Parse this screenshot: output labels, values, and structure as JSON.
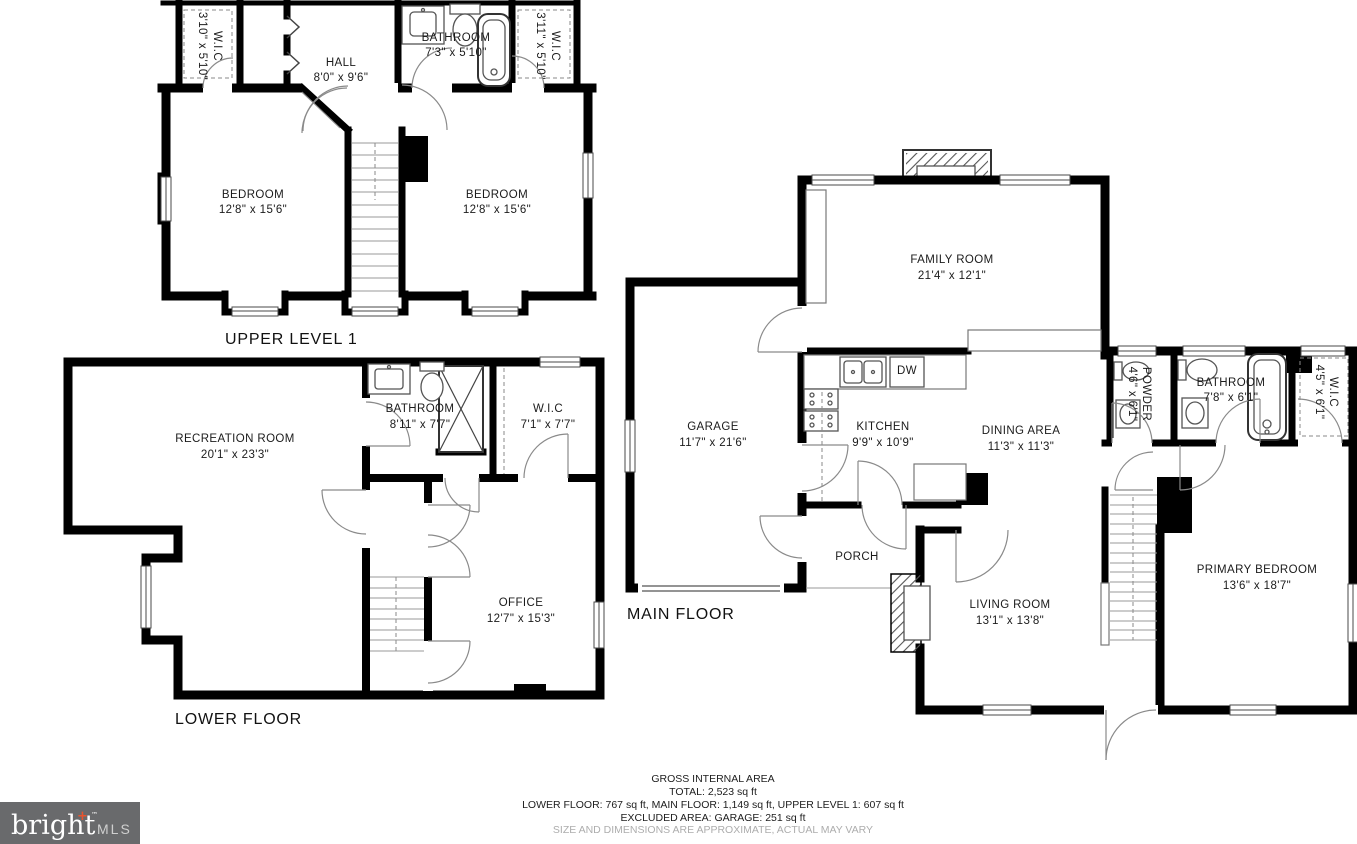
{
  "floors": {
    "upper": {
      "label": "UPPER LEVEL 1",
      "rooms": {
        "wic_left": {
          "name": "W.I.C",
          "dims": "3'10\" x 5'10\""
        },
        "hall": {
          "name": "HALL",
          "dims": "8'0\" x 9'6\""
        },
        "bathroom": {
          "name": "BATHROOM",
          "dims": "7'3\" x 5'10\""
        },
        "wic_right": {
          "name": "W.I.C",
          "dims": "3'11\" x 5'10\""
        },
        "bedroom_left": {
          "name": "BEDROOM",
          "dims": "12'8\" x 15'6\""
        },
        "bedroom_right": {
          "name": "BEDROOM",
          "dims": "12'8\" x 15'6\""
        }
      }
    },
    "lower": {
      "label": "LOWER FLOOR",
      "rooms": {
        "recreation": {
          "name": "RECREATION ROOM",
          "dims": "20'1\" x 23'3\""
        },
        "bathroom": {
          "name": "BATHROOM",
          "dims": "8'11\" x 7'7\""
        },
        "wic": {
          "name": "W.I.C",
          "dims": "7'1\" x 7'7\""
        },
        "office": {
          "name": "OFFICE",
          "dims": "12'7\" x 15'3\""
        }
      }
    },
    "main": {
      "label": "MAIN FLOOR",
      "kitchen_dw": "DW",
      "rooms": {
        "family": {
          "name": "FAMILY ROOM",
          "dims": "21'4\" x 12'1\""
        },
        "garage": {
          "name": "GARAGE",
          "dims": "11'7\" x 21'6\""
        },
        "kitchen": {
          "name": "KITCHEN",
          "dims": "9'9\" x 10'9\""
        },
        "dining": {
          "name": "DINING AREA",
          "dims": "11'3\" x 11'3\""
        },
        "powder": {
          "name": "POWDER",
          "dims": "4'6\" x 6'1\""
        },
        "bathroom": {
          "name": "BATHROOM",
          "dims": "7'8\" x 6'1\""
        },
        "wic": {
          "name": "W.I.C",
          "dims": "4'5\" x 6'1\""
        },
        "porch": {
          "name": "PORCH",
          "dims": ""
        },
        "living": {
          "name": "LIVING ROOM",
          "dims": "13'1\" x 13'8\""
        },
        "primary": {
          "name": "PRIMARY BEDROOM",
          "dims": "13'6\" x 18'7\""
        }
      }
    }
  },
  "footer": {
    "line1": "GROSS INTERNAL AREA",
    "line2": "TOTAL: 2,523 sq ft",
    "line3": "LOWER FLOOR: 767 sq ft, MAIN FLOOR: 1,149 sq ft, UPPER LEVEL 1: 607 sq ft",
    "line4": "EXCLUDED AREA: GARAGE: 251 sq ft",
    "line5": "SIZE AND DIMENSIONS ARE APPROXIMATE, ACTUAL MAY VARY"
  },
  "logo": {
    "brand": "bright",
    "plus": "+",
    "tm": "™",
    "suffix": "MLS",
    "bg": "#696a6c",
    "accent": "#e8542e"
  }
}
